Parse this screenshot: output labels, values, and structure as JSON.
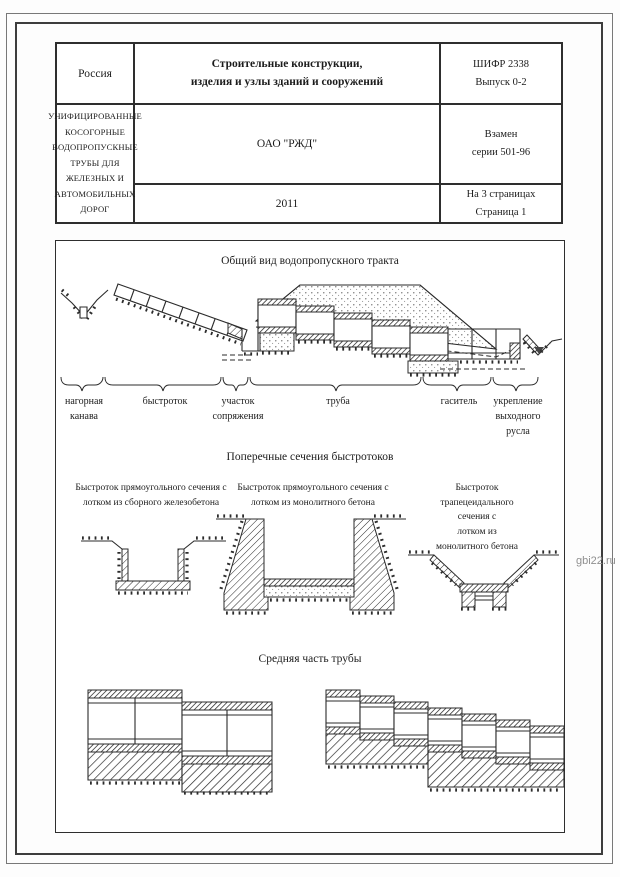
{
  "document": {
    "watermark": "gbi22.ru",
    "colors": {
      "line": "#2b2b2b",
      "watermark_gray": "#8f8f8f",
      "paper": "#ffffff"
    },
    "header_table": {
      "country": "Россия",
      "subject": "Строительные конструкции,\nизделия и узлы зданий и сооружений",
      "code": "ШИФР 2338\nВыпуск 0-2",
      "organization": "ОАО \"РЖД\"",
      "title": "УНИФИЦИРОВАННЫЕ КОСОГОРНЫЕ ВОДОПРОПУСКНЫЕ ТРУБЫ ДЛЯ\nЖЕЛЕЗНЫХ И АВТОМОБИЛЬНЫХ ДОРОГ",
      "replaces": "Взамен\nсерии 501-96",
      "year": "2011",
      "pages": "На 3 страницах\nСтраница 1"
    },
    "sections": {
      "general_view": {
        "title": "Общий вид водопропускного тракта",
        "labels": [
          "нагорная\nканава",
          "быстроток",
          "участок\nсопряжения",
          "труба",
          "гаситель",
          "укрепление\nвыходного\nрусла"
        ]
      },
      "cross_sections": {
        "title": "Поперечные сечения быстротоков",
        "captions": [
          "Быстроток прямоугольного сечения с\nлотком из сборного железобетона",
          "Быстроток прямоугольного сечения с\nлотком из монолитного бетона",
          "Быстроток трапецеидального сечения с\nлотком из монолитного бетона"
        ]
      },
      "middle_part": {
        "title": "Средняя часть трубы"
      }
    }
  }
}
